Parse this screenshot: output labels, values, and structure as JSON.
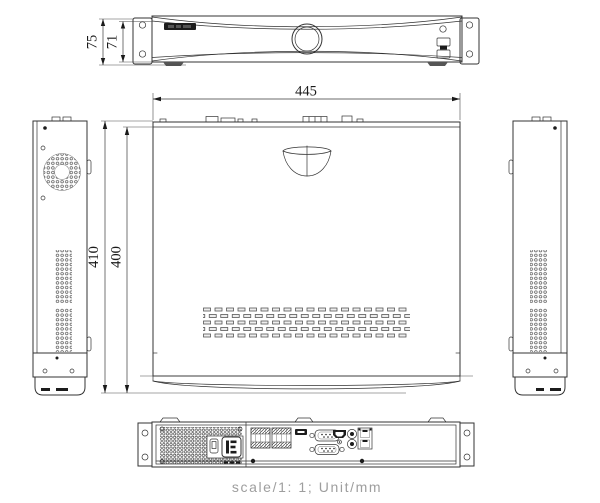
{
  "dims": {
    "front_overall_height": "75",
    "front_panel_height": "71",
    "width": "445",
    "depth_overall": "410",
    "depth_chassis": "400"
  },
  "note": {
    "text": "scale/1: 1; Unit/mm"
  },
  "colors": {
    "line": "#333333",
    "dim_text": "#1a1a1a",
    "note_text": "#9e9e9e",
    "background": "#ffffff",
    "dark_fill": "#1c1c1c"
  }
}
